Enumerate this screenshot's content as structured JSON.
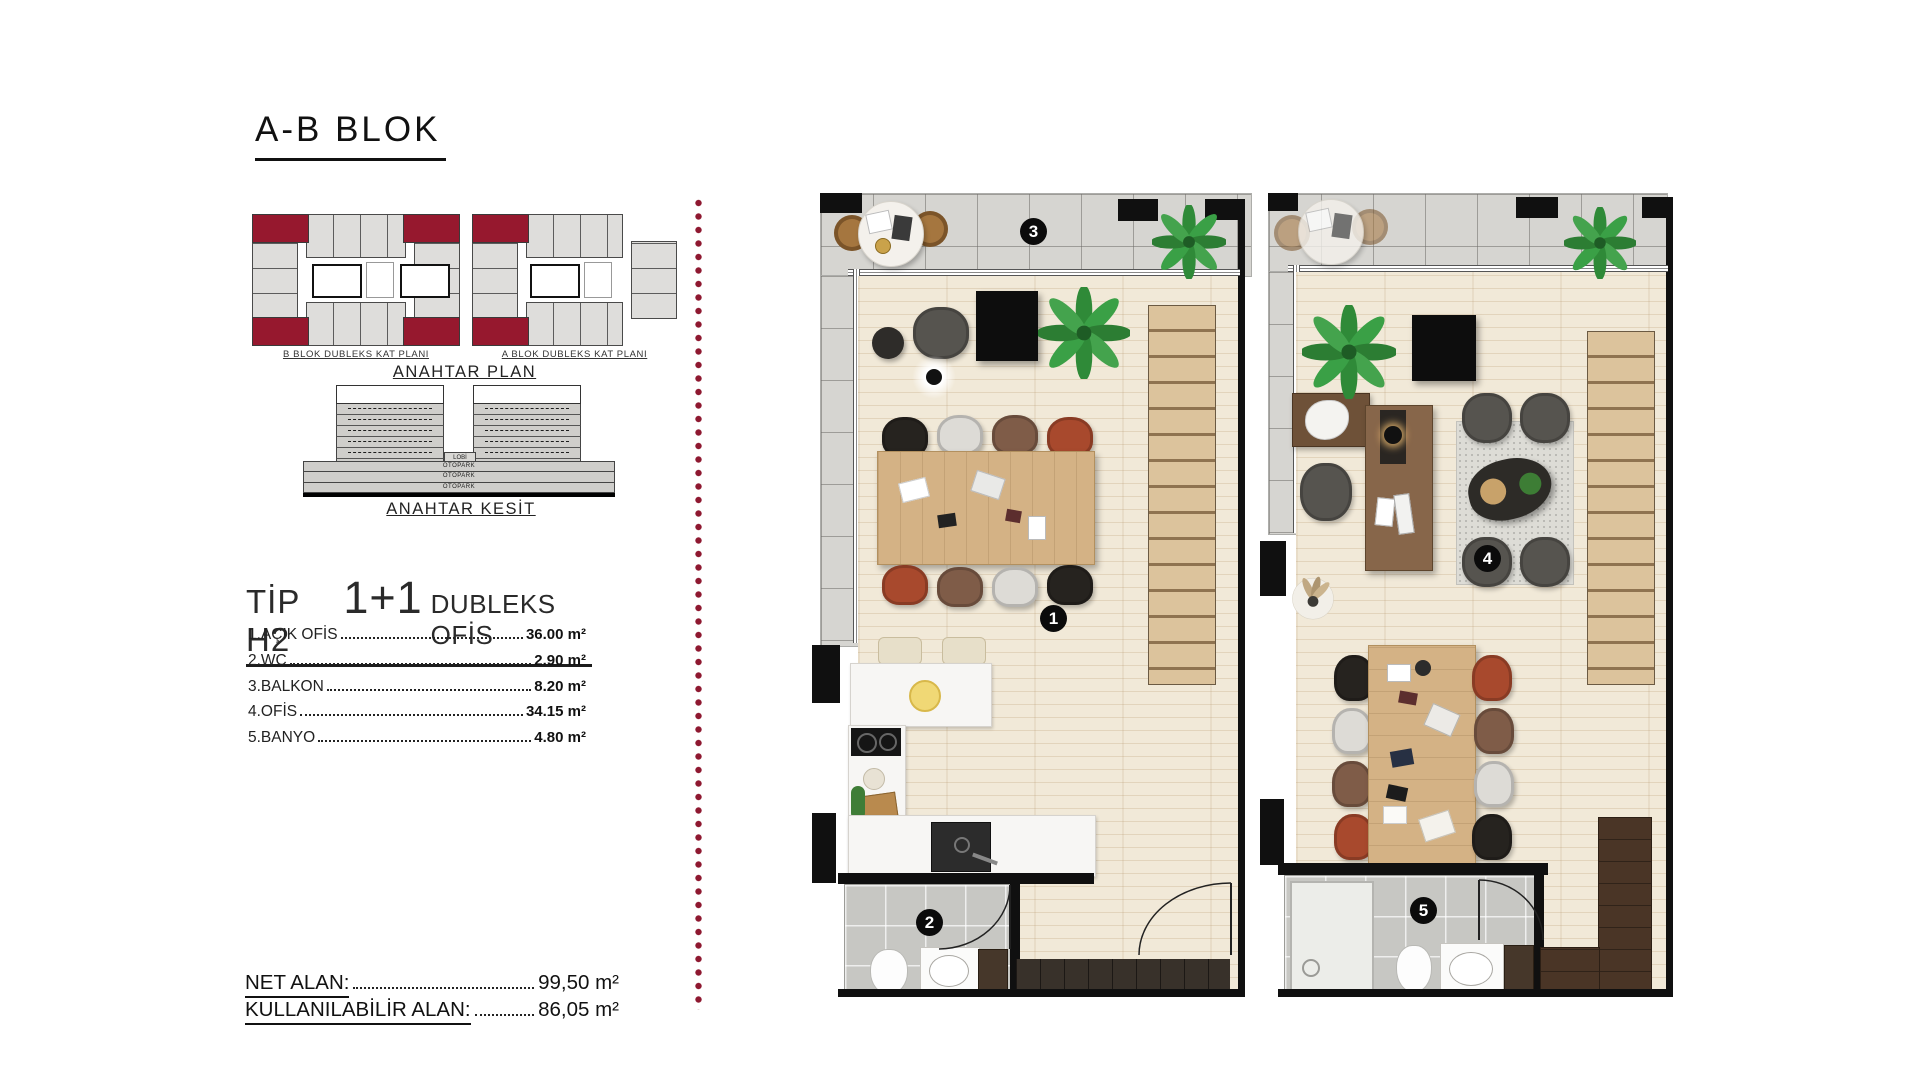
{
  "title": "A-B BLOK",
  "key_plan": {
    "heading": "ANAHTAR PLAN",
    "b_label": "B BLOK DUBLEKS KAT PLANI",
    "a_label": "A BLOK DUBLEKS KAT PLANI"
  },
  "key_section": {
    "heading": "ANAHTAR KESİT",
    "lobby_label": "LOBİ",
    "parking_labels": [
      "OTOPARK",
      "OTOPARK",
      "OTOPARK"
    ]
  },
  "unit": {
    "type_label": "TİP H2",
    "plus_label": "1+1",
    "kind_label": "DUBLEKS OFİS"
  },
  "rooms": [
    {
      "name": "1.AÇIK OFİS",
      "area": "36.00 m²"
    },
    {
      "name": "2.WC",
      "area": "2.90 m²"
    },
    {
      "name": "3.BALKON",
      "area": "8.20 m²"
    },
    {
      "name": "4.OFİS",
      "area": "34.15 m²"
    },
    {
      "name": "5.BANYO",
      "area": "4.80 m²"
    }
  ],
  "totals": {
    "net_label": "NET ALAN:",
    "net_value": "99,50 m²",
    "usable_label": "KULLANILABİLİR ALAN:",
    "usable_value": "86,05 m²"
  },
  "plans": {
    "lower": {
      "markers": {
        "open_office": "1",
        "wc": "2",
        "balcony": "3"
      }
    },
    "upper": {
      "markers": {
        "office": "4",
        "bathroom": "5"
      }
    }
  },
  "colors": {
    "accent_maroon": "#96182e",
    "wall_black": "#101010"
  }
}
